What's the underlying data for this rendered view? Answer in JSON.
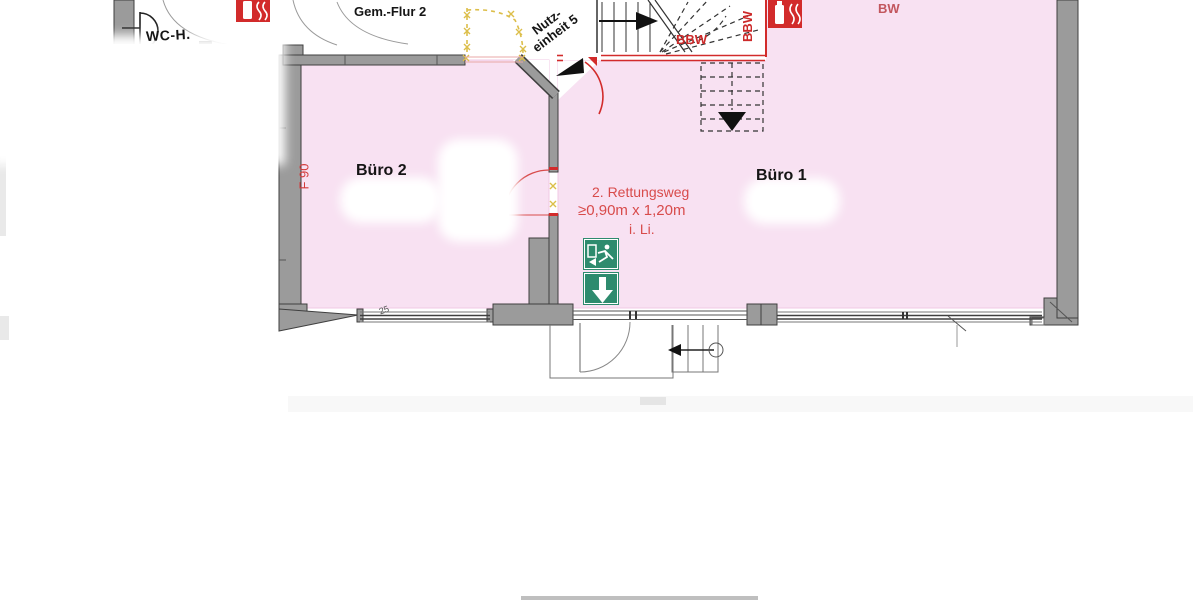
{
  "document": {
    "kind": "fire-escape floor plan",
    "labels": {
      "gem_flur_2": "Gem.-Flur 2",
      "wc_h": "WC-H.",
      "nutzeinheit_line1": "Nutz-",
      "nutzeinheit_line2": "einheit 5",
      "buero_2": "Büro 2",
      "buero_1": "Büro 1",
      "f_90": "F 90",
      "bw": "BW",
      "bbw_horizontal": "BBW",
      "bbw_vertical": "BBW",
      "rettungsweg_line1": "2. Rettungsweg",
      "rettungsweg_line2": "≥0,90m x 1,20m",
      "rettungsweg_line3": "i. Li.",
      "dim_25": "25"
    },
    "icons": {
      "fire_extinguisher_left": "fire-extinguisher-pictogram",
      "fire_extinguisher_stair": "fire-extinguisher-pictogram",
      "exit_sign_top": "running-man-exit-pictogram",
      "exit_sign_bottom": "down-arrow-exit-pictogram",
      "stair_up_arrow": "direction-triangle-right",
      "stair_down_arrow": "direction-triangle-down",
      "unit_pointer": "direction-triangle-down-left",
      "door_closer": "arrow-with-circle",
      "wc_fixture": "half-circle-fixture"
    },
    "colors": {
      "room_fill": "#f8e1f2",
      "wall_fill": "#9b9b9b",
      "wall_edge": "#3f3f3f",
      "fire_red": "#d22b2b",
      "annotation_red": "#d84b4b",
      "escape_green": "#2e8b6e",
      "marker_yellow": "#dcbe4a",
      "text_black": "#151515",
      "line_gray": "#777777"
    }
  }
}
